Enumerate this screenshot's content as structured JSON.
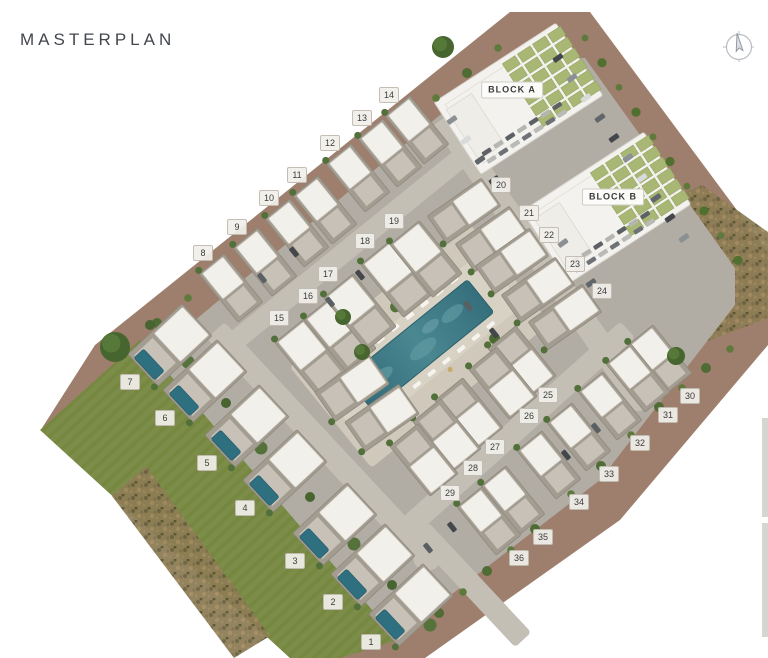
{
  "header": {
    "title": "MASTERPLAN"
  },
  "icons": {
    "compass": "compass-rose-icon"
  },
  "colors": {
    "earth_band": "#9e7e6c",
    "lawn": "#7c8d4a",
    "hardscape": "#b2ada4",
    "road": "#c4bfb5",
    "courtyard": "#cfc8bb",
    "pool": "#3e7a85",
    "solar_panel": "#a8b773",
    "building": "#f3f2ee",
    "chip_bg": "#f1efea",
    "title_text": "#42464d"
  },
  "site": {
    "blocks": [
      {
        "label": "BLOCK A",
        "x": 512,
        "y": 90
      },
      {
        "label": "BLOCK B",
        "x": 613,
        "y": 197
      }
    ],
    "plots": [
      {
        "n": "1",
        "x": 371,
        "y": 642
      },
      {
        "n": "2",
        "x": 333,
        "y": 602
      },
      {
        "n": "3",
        "x": 295,
        "y": 561
      },
      {
        "n": "4",
        "x": 245,
        "y": 508
      },
      {
        "n": "5",
        "x": 207,
        "y": 463
      },
      {
        "n": "6",
        "x": 165,
        "y": 418
      },
      {
        "n": "7",
        "x": 130,
        "y": 382
      },
      {
        "n": "8",
        "x": 203,
        "y": 253
      },
      {
        "n": "9",
        "x": 237,
        "y": 227
      },
      {
        "n": "10",
        "x": 269,
        "y": 198
      },
      {
        "n": "11",
        "x": 297,
        "y": 175
      },
      {
        "n": "12",
        "x": 330,
        "y": 143
      },
      {
        "n": "13",
        "x": 362,
        "y": 118
      },
      {
        "n": "14",
        "x": 389,
        "y": 95
      },
      {
        "n": "15",
        "x": 279,
        "y": 318
      },
      {
        "n": "16",
        "x": 308,
        "y": 296
      },
      {
        "n": "17",
        "x": 328,
        "y": 274
      },
      {
        "n": "18",
        "x": 365,
        "y": 241
      },
      {
        "n": "19",
        "x": 394,
        "y": 221
      },
      {
        "n": "20",
        "x": 501,
        "y": 185
      },
      {
        "n": "21",
        "x": 529,
        "y": 213
      },
      {
        "n": "22",
        "x": 549,
        "y": 235
      },
      {
        "n": "23",
        "x": 575,
        "y": 264
      },
      {
        "n": "24",
        "x": 602,
        "y": 291
      },
      {
        "n": "25",
        "x": 548,
        "y": 395
      },
      {
        "n": "26",
        "x": 529,
        "y": 416
      },
      {
        "n": "27",
        "x": 495,
        "y": 447
      },
      {
        "n": "28",
        "x": 473,
        "y": 468
      },
      {
        "n": "29",
        "x": 450,
        "y": 493
      },
      {
        "n": "30",
        "x": 690,
        "y": 396
      },
      {
        "n": "31",
        "x": 668,
        "y": 415
      },
      {
        "n": "32",
        "x": 640,
        "y": 443
      },
      {
        "n": "33",
        "x": 609,
        "y": 474
      },
      {
        "n": "34",
        "x": 579,
        "y": 502
      },
      {
        "n": "35",
        "x": 543,
        "y": 537
      },
      {
        "n": "36",
        "x": 519,
        "y": 558
      }
    ]
  }
}
